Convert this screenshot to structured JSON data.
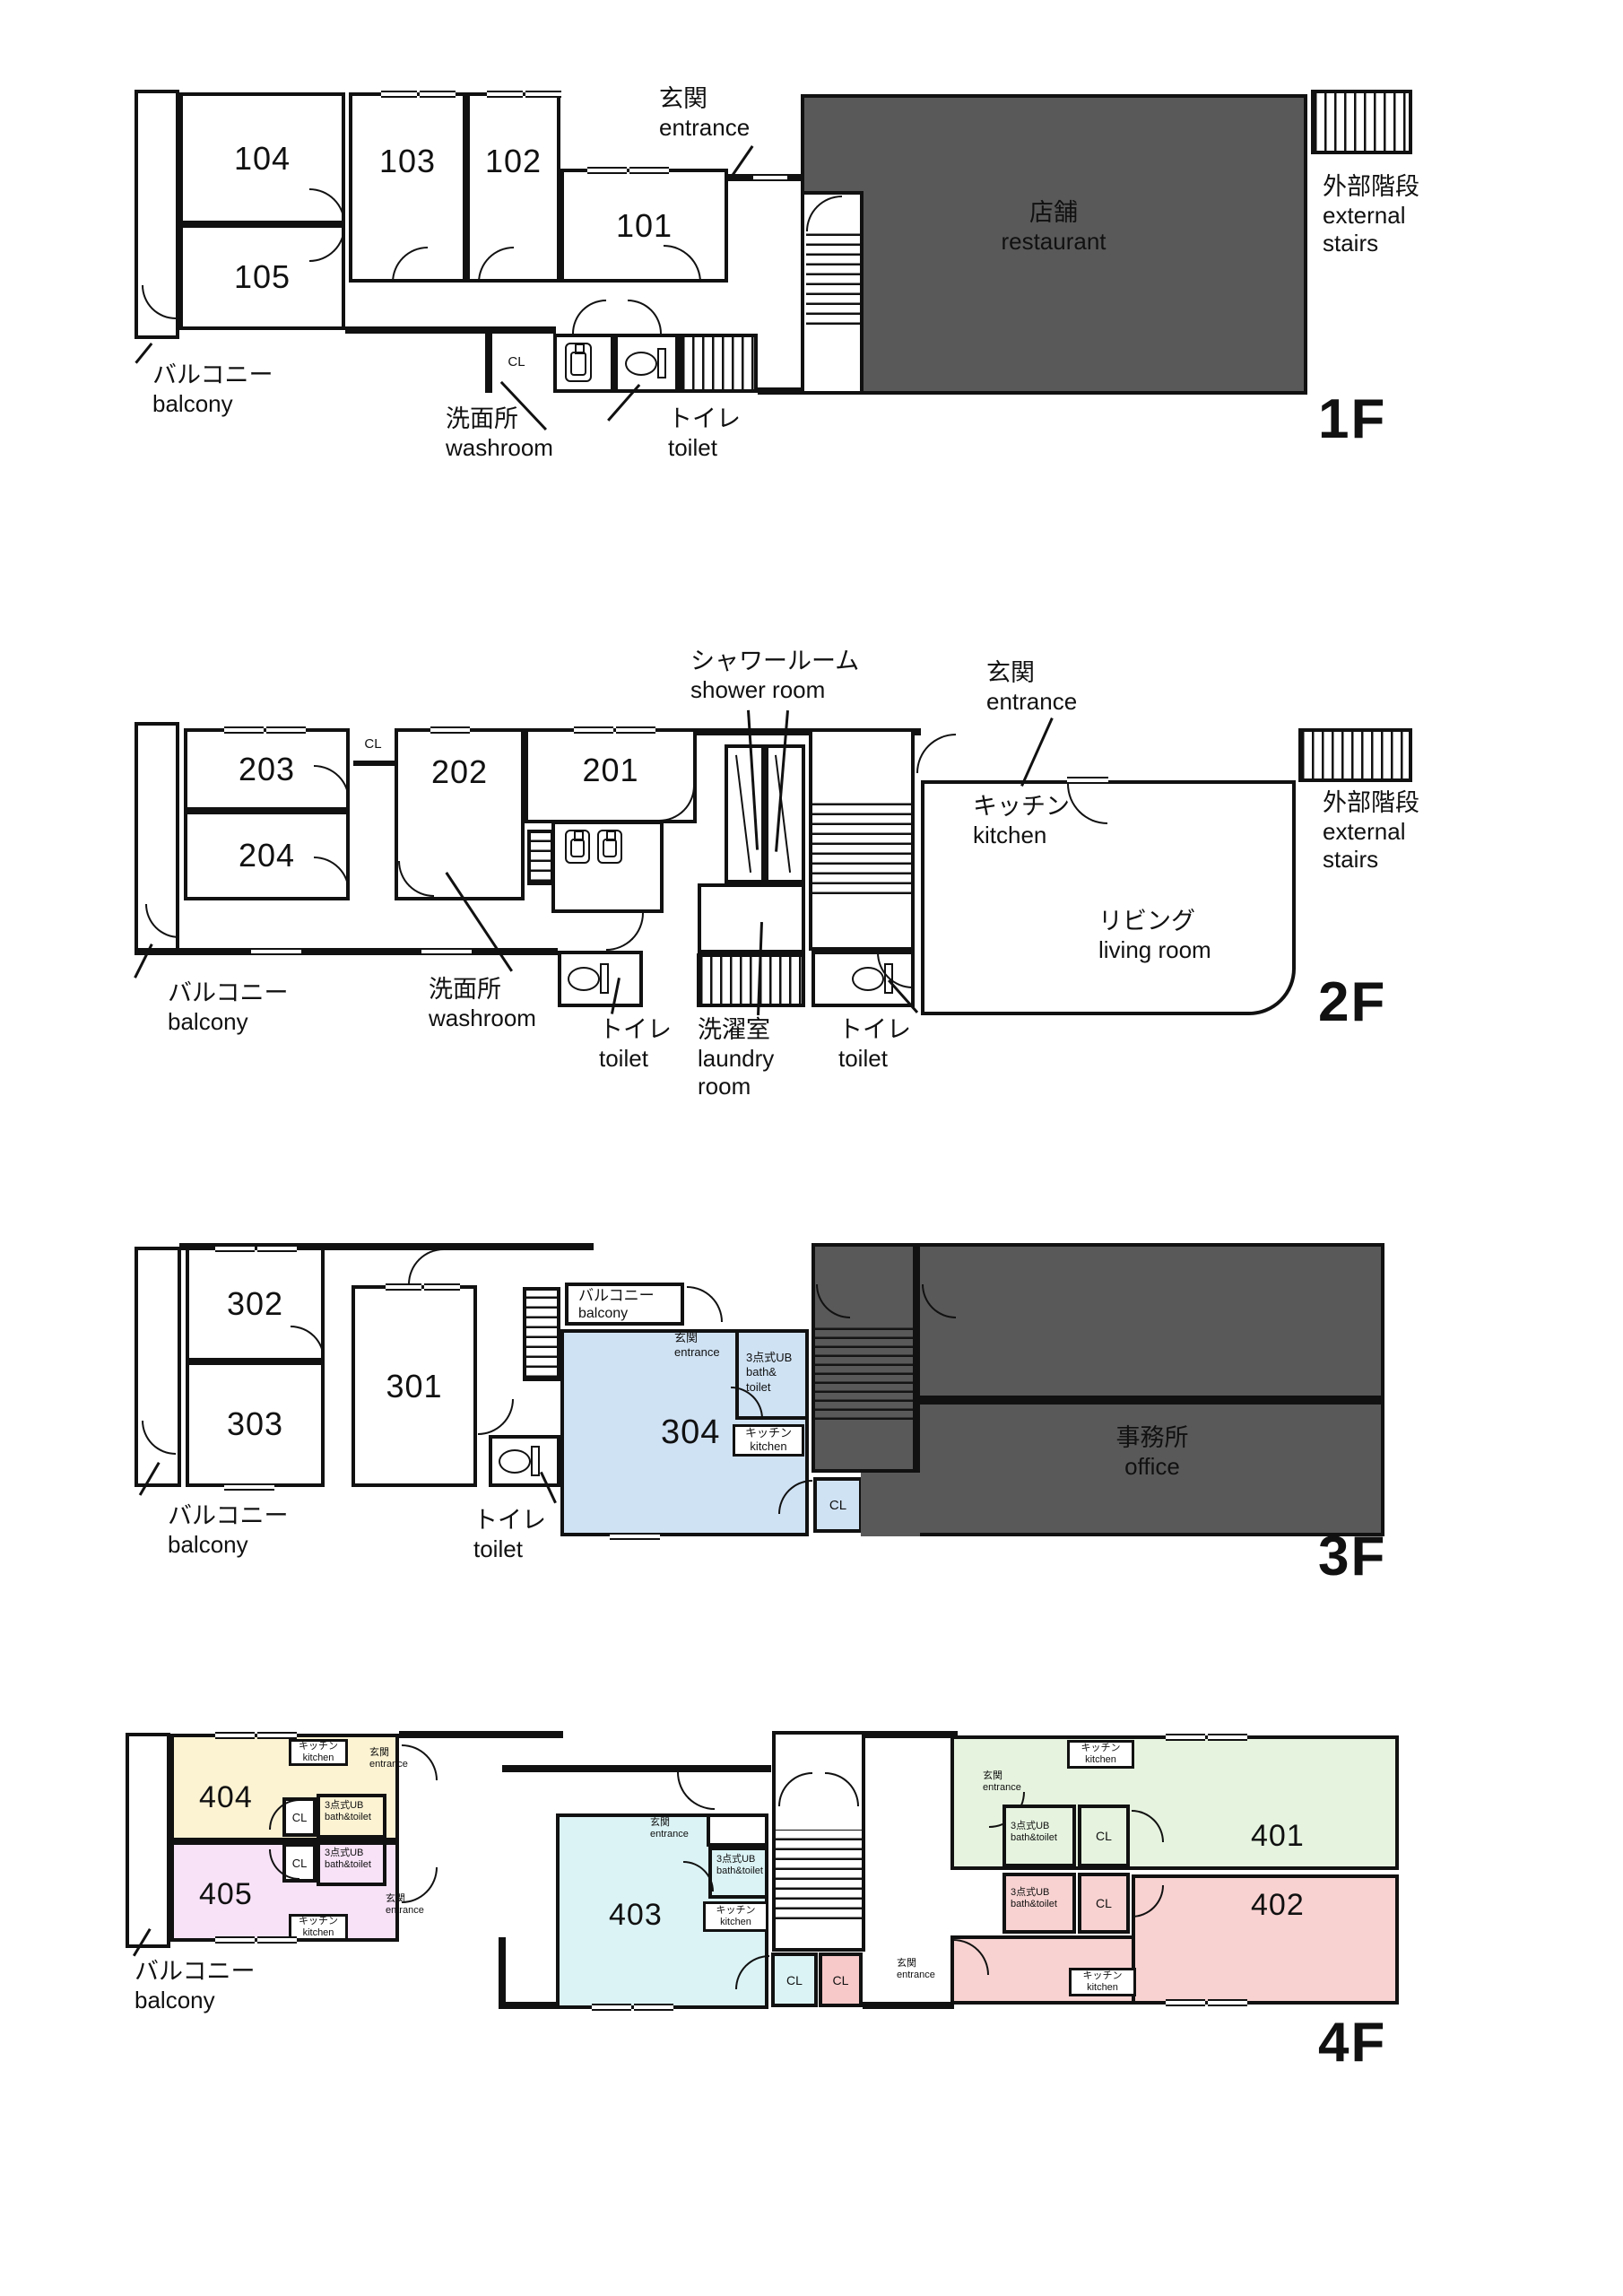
{
  "colors": {
    "wall": "#111111",
    "dark_area": "#595959",
    "room_304": "#cfe2f4",
    "room_404": "#fcf3d3",
    "room_405": "#f7e2f7",
    "room_403": "#dbf3f5",
    "room_401": "#e6f4df",
    "room_402": "#f8d2d1",
    "cl_pink": "#f8c9c9"
  },
  "floors": {
    "f1": {
      "label": "1F",
      "r101": "101",
      "r102": "102",
      "r103": "103",
      "r104": "104",
      "r105": "105",
      "cl": "CL",
      "balcony_ja": "バルコニー",
      "balcony_en": "balcony",
      "entrance_ja": "玄関",
      "entrance_en": "entrance",
      "washroom_ja": "洗面所",
      "washroom_en": "washroom",
      "toilet_ja": "トイレ",
      "toilet_en": "toilet",
      "restaurant_ja": "店舗",
      "restaurant_en": "restaurant",
      "ext_stairs_ja": "外部階段",
      "ext_stairs_en1": "external",
      "ext_stairs_en2": "stairs"
    },
    "f2": {
      "label": "2F",
      "r201": "201",
      "r202": "202",
      "r203": "203",
      "r204": "204",
      "cl": "CL",
      "balcony_ja": "バルコニー",
      "balcony_en": "balcony",
      "entrance_ja": "玄関",
      "entrance_en": "entrance",
      "shower_ja": "シャワールーム",
      "shower_en": "shower room",
      "washroom_ja": "洗面所",
      "washroom_en": "washroom",
      "toilet_ja": "トイレ",
      "toilet_en": "toilet",
      "laundry_ja": "洗濯室",
      "laundry_en1": "laundry",
      "laundry_en2": "room",
      "kitchen_ja": "キッチン",
      "kitchen_en": "kitchen",
      "living_ja": "リビング",
      "living_en": "living room",
      "ext_stairs_ja": "外部階段",
      "ext_stairs_en1": "external",
      "ext_stairs_en2": "stairs"
    },
    "f3": {
      "label": "3F",
      "r301": "301",
      "r302": "302",
      "r303": "303",
      "r304": "304",
      "cl": "CL",
      "balcony_ja": "バルコニー",
      "balcony_en": "balcony",
      "entrance_ja": "玄関",
      "entrance_en": "entrance",
      "bath_ja": "3点式UB",
      "bath_en1": "bath&",
      "bath_en2": "toilet",
      "kitchen_ja": "キッチン",
      "kitchen_en": "kitchen",
      "toilet_ja": "トイレ",
      "toilet_en": "toilet",
      "office_ja": "事務所",
      "office_en": "office"
    },
    "f4": {
      "label": "4F",
      "r401": "401",
      "r402": "402",
      "r403": "403",
      "r404": "404",
      "r405": "405",
      "cl": "CL",
      "balcony_ja": "バルコニー",
      "balcony_en": "balcony",
      "entrance_ja": "玄関",
      "entrance_en": "entrance",
      "kitchen_ja": "キッチン",
      "kitchen_en": "kitchen",
      "bath_ja": "3点式UB",
      "bath_en": "bath&toilet"
    }
  }
}
